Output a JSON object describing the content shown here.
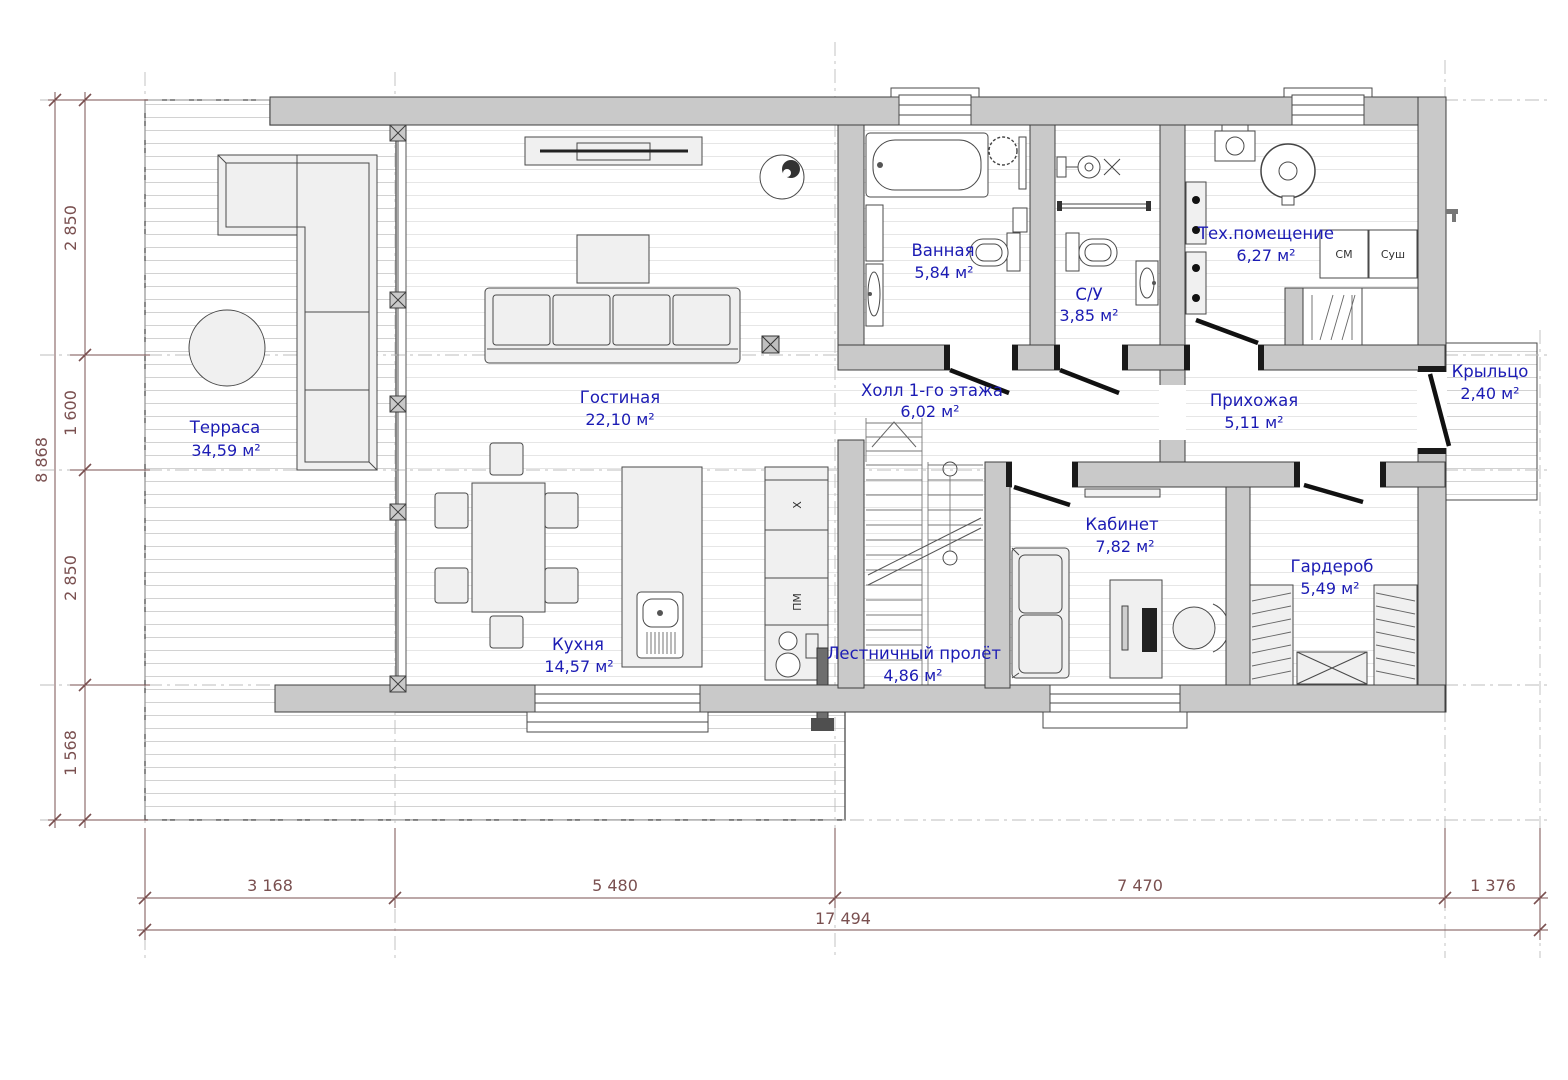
{
  "plan": {
    "title": "План 1-го этажа",
    "rooms": {
      "terrace": {
        "name": "Терраса",
        "area": "34,59 м²"
      },
      "living": {
        "name": "Гостиная",
        "area": "22,10 м²"
      },
      "kitchen": {
        "name": "Кухня",
        "area": "14,57 м²"
      },
      "bathroom": {
        "name": "Ванная",
        "area": "5,84 м²"
      },
      "wc": {
        "name": "С/У",
        "area": "3,85 м²"
      },
      "tech": {
        "name": "Тех.помещение",
        "area": "6,27 м²"
      },
      "hall": {
        "name": "Холл 1-го этажа",
        "area": "6,02 м²"
      },
      "entry": {
        "name": "Прихожая",
        "area": "5,11 м²"
      },
      "porch": {
        "name": "Крыльцо",
        "area": "2,40 м²"
      },
      "office": {
        "name": "Кабинет",
        "area": "7,82 м²"
      },
      "wardrobe": {
        "name": "Гардероб",
        "area": "5,49 м²"
      },
      "stairs": {
        "name": "Лестничный пролёт",
        "area": "4,86 м²"
      }
    },
    "appliances": {
      "washing_machine": "СМ",
      "dryer": "Суш",
      "hob": "X",
      "dishwasher": "ПМ"
    },
    "dimensions": {
      "left": [
        "2 850",
        "1 600",
        "2 850",
        "1 568"
      ],
      "left_total": "8 868",
      "bottom": [
        "3 168",
        "5 480",
        "7 470",
        "1 376"
      ],
      "bottom_total": "17 494"
    },
    "colors": {
      "label": "#1c1cb4",
      "dimension": "#7a5050",
      "wall": "#c9c9c9"
    }
  }
}
